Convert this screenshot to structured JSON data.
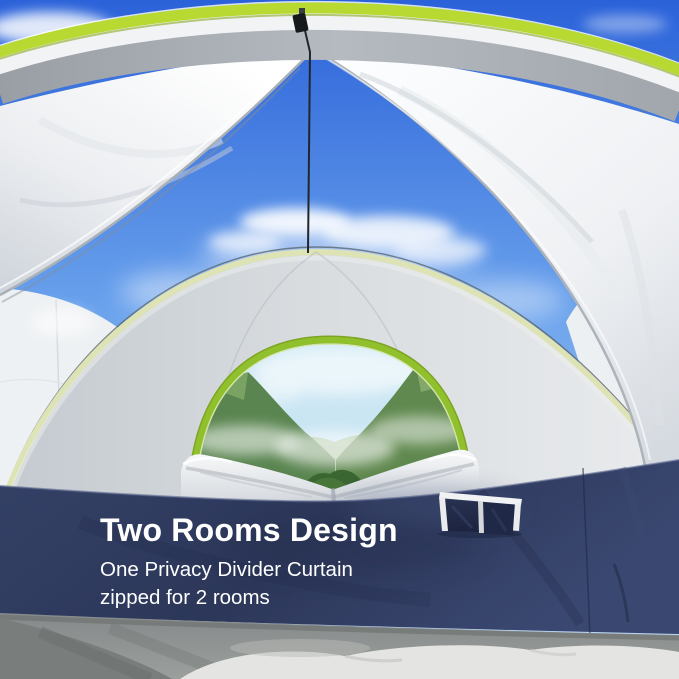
{
  "scene_description": "Interior view of a dome camping tent with its privacy divider curtain opened; an arched rear window with green zipper trim shows green mountains, navy lower walls with a storage pocket, and a gray tent floor.",
  "overlay_text": {
    "title": "Two Rooms Design",
    "line1": "One Privacy Divider Curtain",
    "line2": "zipped for 2 rooms"
  },
  "colors": {
    "text": "#ffffff",
    "navy_band": "#2e3a5e",
    "lime_trim": "#b7d931",
    "sage_trim": "#dde3b4",
    "window_zipper": "#90c12d",
    "sky_deep": "#2b62d9",
    "sky_light": "#a9ccf3",
    "curtain_white": "#f4f5f7",
    "back_wall_gray": "#d8dcdf",
    "floor_gray": "#8f9392",
    "mountain_green": "#5a8550"
  }
}
